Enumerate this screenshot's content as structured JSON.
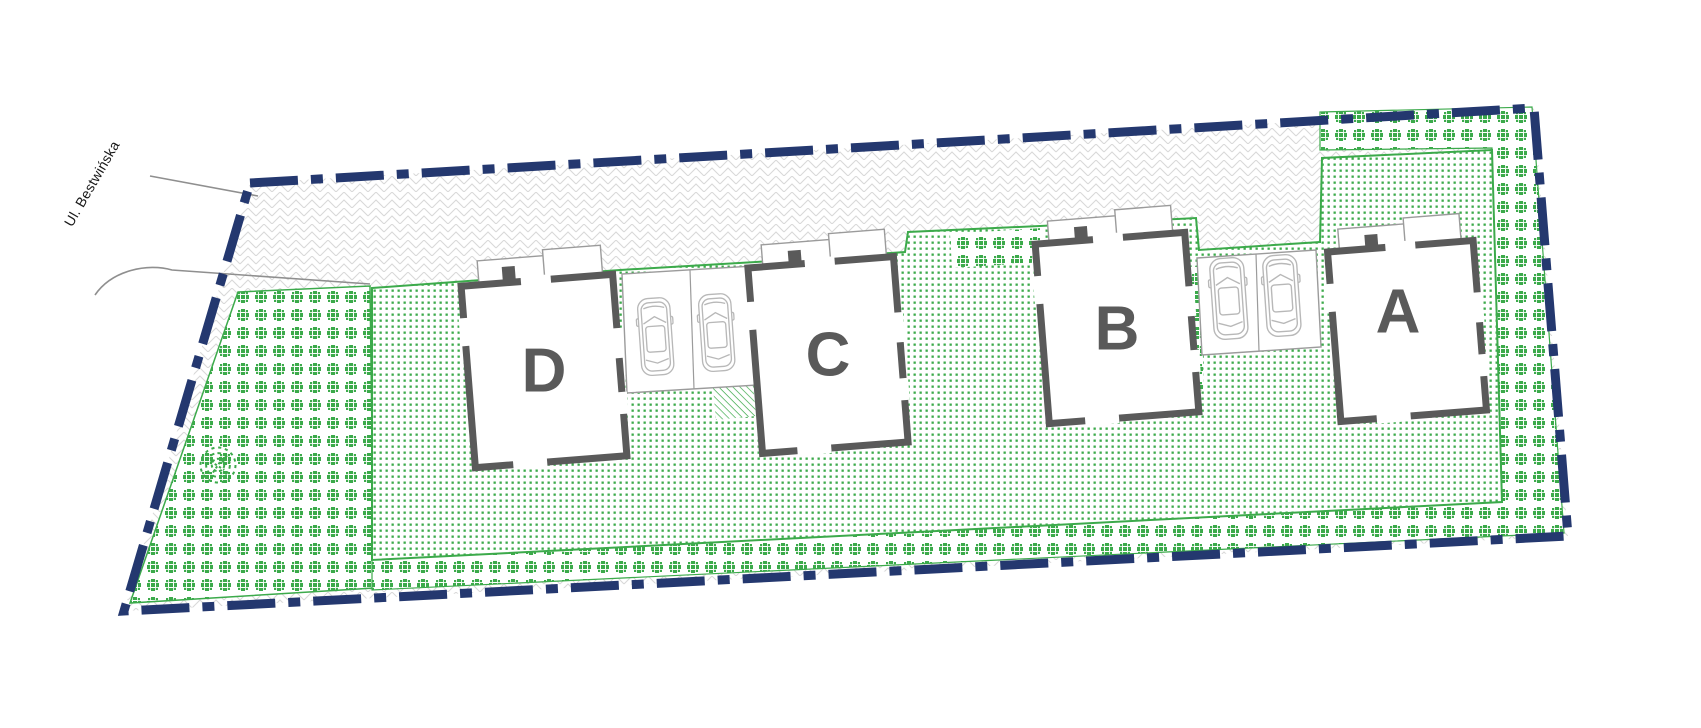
{
  "plan": {
    "street_label": "Ul. Bestwińska",
    "buildings": [
      {
        "id": "A",
        "label": "A"
      },
      {
        "id": "B",
        "label": "B"
      },
      {
        "id": "C",
        "label": "C"
      },
      {
        "id": "D",
        "label": "D"
      }
    ],
    "parking": {
      "pad_count": 2,
      "car_count": 4
    },
    "colors": {
      "boundary_navy": "#24386f",
      "green": "#3caa4b",
      "building_wall": "#5a5a5a",
      "building_letter": "#5a5a5a",
      "paving_line": "#d8d8d8",
      "car_outline": "#b8b8b8",
      "road_line": "#8f8f8f"
    }
  }
}
